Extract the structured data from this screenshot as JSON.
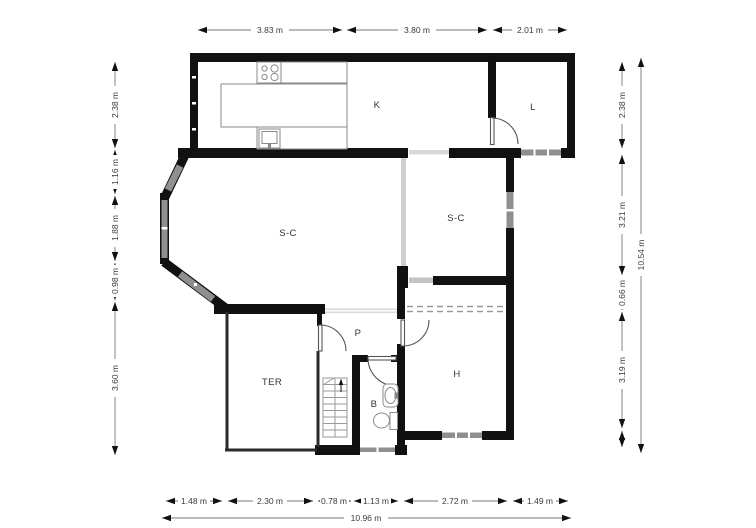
{
  "rooms": {
    "kitchen": "K",
    "laundry": "L",
    "living_left": "S-C",
    "living_right": "S-C",
    "hall": "P",
    "terrace": "TER",
    "bath": "B",
    "bedroom": "H"
  },
  "dimensions": {
    "top": [
      "3.83 m",
      "3.80 m",
      "2.01 m"
    ],
    "left": [
      "2.38 m",
      "1.16 m",
      "1.88 m",
      "0.98 m",
      "3.60 m"
    ],
    "right": [
      "2.38 m",
      "3.21 m",
      "0.66 m",
      "3.19 m"
    ],
    "right_total": "10.54 m",
    "bottom": [
      "1.48 m",
      "2.30 m",
      "0.78 m",
      "1.13 m",
      "2.72 m",
      "1.49 m"
    ],
    "bottom_total": "10.96 m"
  },
  "colors": {
    "wall": "#111111",
    "window": "#8f8f8f",
    "dimension_line": "#777777"
  }
}
